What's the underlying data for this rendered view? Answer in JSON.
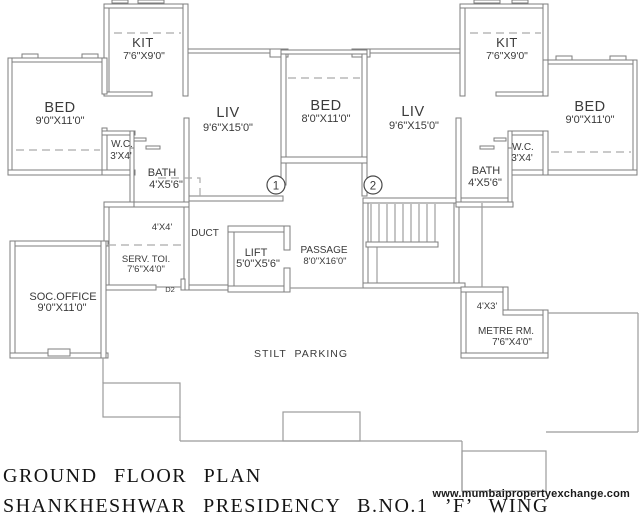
{
  "colors": {
    "wall_stroke": "#7d7d7d",
    "boundary": "#9b9b9b",
    "text": "#3a3a3a",
    "title": "#141414",
    "background": "#ffffff"
  },
  "rooms": {
    "kit_left": {
      "name": "KIT",
      "dims": "7'6\"X9'0\""
    },
    "bed_left": {
      "name": "BED",
      "dims": "9'0\"X11'0\""
    },
    "liv_left": {
      "name": "LIV",
      "dims": "9'6\"X15'0\""
    },
    "bed_center": {
      "name": "BED",
      "dims": "8'0\"X11'0\""
    },
    "liv_right": {
      "name": "LIV",
      "dims": "9'6\"X15'0\""
    },
    "kit_right": {
      "name": "KIT",
      "dims": "7'6\"X9'0\""
    },
    "bed_right": {
      "name": "BED",
      "dims": "9'0\"X11'0\""
    },
    "wc_left": {
      "name": "W.C.",
      "dims": "3'X4'"
    },
    "bath_left": {
      "name": "BATH",
      "dims": "4'X5'6\""
    },
    "wc_right": {
      "name": "W.C.",
      "dims": "3'X4'"
    },
    "bath_right": {
      "name": "BATH",
      "dims": "4'X5'6\""
    },
    "store_4x4": {
      "dims": "4'X4'"
    },
    "duct": {
      "name": "DUCT"
    },
    "lift": {
      "name": "LIFT",
      "dims": "5'0\"X5'6\""
    },
    "passage": {
      "name": "PASSAGE",
      "dims": "8'0\"X16'0\""
    },
    "serv_toi": {
      "name": "SERV. TOI.",
      "dims": "7'6\"X4'0\""
    },
    "soc_office": {
      "name": "SOC.OFFICE",
      "dims": "9'0\"X11'0\""
    },
    "meter_4x3": {
      "dims": "4'X3'"
    },
    "metre_rm": {
      "name": "METRE RM.",
      "dims": "7'6\"X4'0\""
    },
    "stilt": {
      "name": "STILT PARKING"
    }
  },
  "markers": {
    "door_label": "D2",
    "ref1": "1",
    "ref2": "2"
  },
  "titles": {
    "plan_title": "GROUND FLOOR PLAN",
    "project_title": "SHANKHESHWAR PRESIDENCY B.NO.1 ’F’ WING"
  },
  "watermark": "www.mumbaipropertyexchange.com"
}
